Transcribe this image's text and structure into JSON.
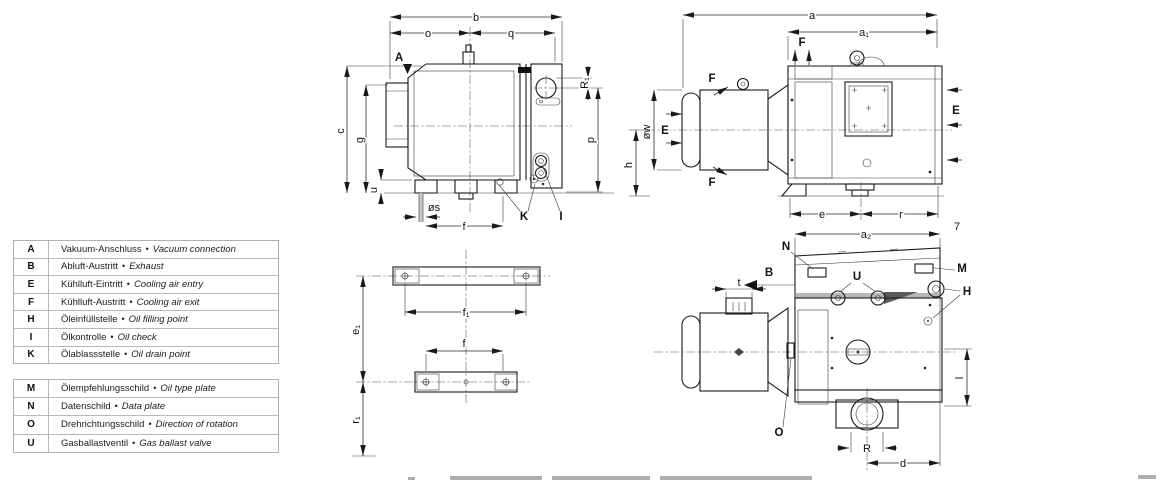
{
  "legend": {
    "bullet": "•",
    "upper_rows": [
      {
        "key": "A",
        "de": "Vakuum-Anschluss",
        "en": "Vacuum connection"
      },
      {
        "key": "B",
        "de": "Abluft-Austritt",
        "en": "Exhaust"
      },
      {
        "key": "E",
        "de": "Kühlluft-Eintritt",
        "en": "Cooling air entry"
      },
      {
        "key": "F",
        "de": "Kühlluft-Austritt",
        "en": "Cooling air exit"
      },
      {
        "key": "H",
        "de": "Öleinfüllstelle",
        "en": "Oil filling point"
      },
      {
        "key": "I",
        "de": "Ölkontrolle",
        "en": "Oil check"
      },
      {
        "key": "K",
        "de": "Ölablassstelle",
        "en": "Oil drain point"
      }
    ],
    "lower_rows": [
      {
        "key": "M",
        "de": "Ölempfehlungsschild",
        "en": "Oil type plate"
      },
      {
        "key": "N",
        "de": "Datenschild",
        "en": "Data plate"
      },
      {
        "key": "O",
        "de": "Drehrichtungsschild",
        "en": "Direction of rotation"
      },
      {
        "key": "U",
        "de": "Gasballastventil",
        "en": "Gas ballast valve"
      }
    ]
  },
  "drawing": {
    "front_view": {
      "port_a": "A",
      "port_k": "K",
      "port_i": "I",
      "dim_b": "b",
      "dim_o": "o",
      "dim_q": "q",
      "dim_c": "c",
      "dim_g": "g",
      "dim_u": "u",
      "dim_p": "p",
      "dim_r1": "R₁",
      "dim_os": "øs",
      "dim_f": "f"
    },
    "top_view": {
      "dim_a": "a",
      "dim_a1": "a₁",
      "dim_ow": "øw",
      "dim_h": "h",
      "dim_e": "e",
      "dim_r": "r",
      "air_entry": "E",
      "air_exit": "F",
      "page_mark": "7"
    },
    "bottom_view": {
      "dim_a2": "a₂",
      "dim_t": "t",
      "dim_port_r": "R",
      "dim_d": "d",
      "dim_l": "l",
      "exhaust_b": "B",
      "data_plate_n": "N",
      "oil_plate_m": "M",
      "gas_ballast_u": "U",
      "oil_fill_h": "H",
      "rotation_o": "O"
    },
    "foot_view": {
      "dim_f1": "f₁",
      "dim_f": "f",
      "dim_e1": "e₁",
      "dim_r1": "r₁"
    }
  }
}
